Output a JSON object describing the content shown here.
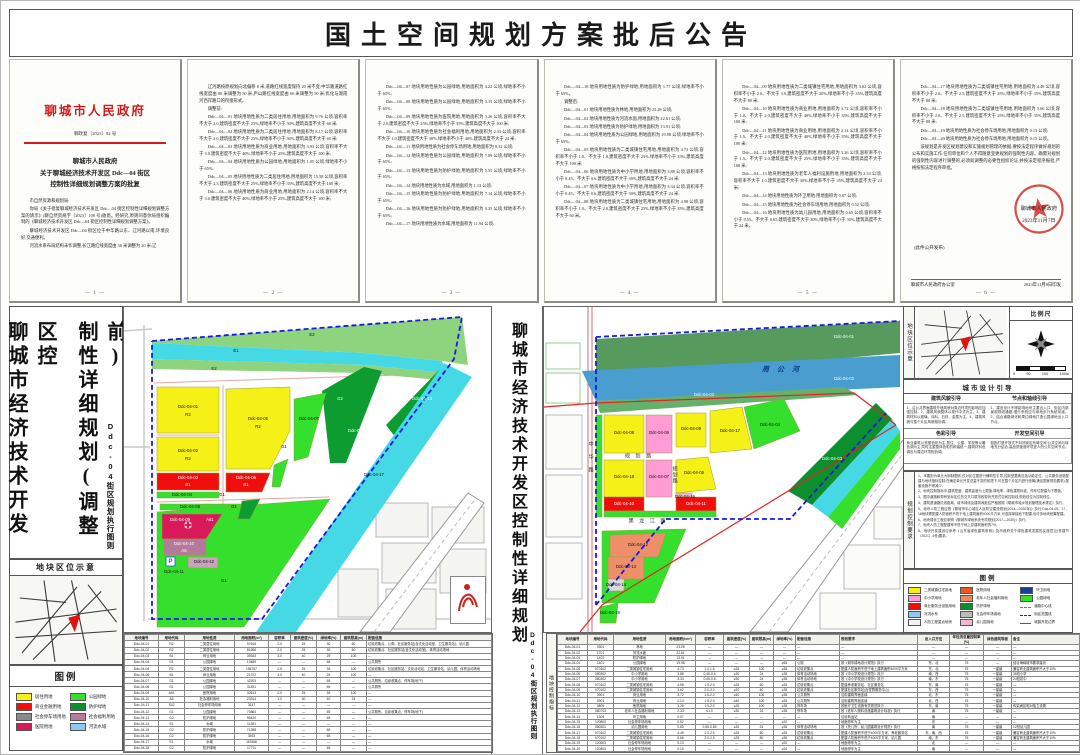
{
  "banner": {
    "title": "国土空间规划方案批后公告"
  },
  "doc": {
    "agency": "聊城市人民政府",
    "doc_no": "聊政复〔2023〕82 号",
    "title_l1": "聊城市人民政府",
    "title_l2": "关于聊城经济技术开发区 Ddc—04 街区",
    "title_l3": "控制性详细规划调整方案的批复",
    "p1": [
      "市自然资源和规划局:",
      "你局《关于批复聊城经济技术开发区 Ddc—04 街区控制性详细规划调整方案的请示》(聊自然资规字〔2023〕108 号)收悉。经研究,原则同意你局组织编制的《聊城经济技术开发区 Ddc—04 街区控制性详细规划调整方案》。",
      "聊城经济技术开发区 Ddc—04 街区位于中华路以东、辽河路以南,环境良好,交通便利。",
      "河流水系布局结构未作调整,长江路红线宽度由 36 米调整为 20 米;辽"
    ],
    "p2": [
      "辽河路按原规划向北偏移 8 米,道路红线宽度保持 20 米不变;中华路道路红线宽度由 80 米调整为 50 米;庐山路红线宽度由 60 米调整为 50 米;优化与湖南河西岸路口的衔接形式。",
      "调整前:",
      "Ddc—04—01 地块用地性质为二类居住用地,用地面积为 9.76 公顷,容积率不大于 2.0,建筑密度不大于 25%,绿地率不小于 30%,建筑高度不大于 60 米;",
      "Ddc—04—02 地块用地性质为二类居住用地,用地面积为 8.17 公顷,容积率不大于 2.0,建筑密度不大于 25%,绿地率不小于 30%,建筑高度不大于 60 米;",
      "Ddc—04—03 地块用地性质为商业用地,用地面积为 3.93 公顷,容积率不大于 3.0,建筑密度不大于 40%,绿地率不小于 25%,建筑高度不大于 100 米;",
      "Ddc—04—04 地块用地性质为公园绿地,用地面积为 1.05 公顷,绿地率不小于 65%;",
      "Ddc—04—05 地块用地性质为二类居住用地,用地面积为 15.58 公顷,容积率不大于 2.5,建筑密度不大于 25%,绿地率不小于 35%,建筑高度不大于 100 米;",
      "Ddc—04—06 地块用地性质为商业用地,用地面积为 2.14 公顷,容积率不大于 3.0,建筑密度不大于 40%,绿地率不小于 25%,建筑高度不大于 100 米;"
    ],
    "p3": [
      "Ddc—04—07 地块用地性质为公园绿地,用地面积为 4.22 公顷,绿地率不小于 65%;",
      "Ddc—04—08 地块用地性质为公园绿地,用地面积为 3.15 公顷,绿地率不小于 65%;",
      "Ddc—04—09 地块用地性质为医院用地,用地面积为 3.26 公顷,容积率不大于 2.0,建筑密度不大于 25%,绿地率不小于 35%,建筑高度不大于 100 米;",
      "Ddc—04—10 地块用地性质为社会福利用地,用地面积为 2.33 公顷,容积率不大于 1.0,建筑密度不大于 30%,绿地率不小于 40%,建筑高度不大于 24 米;",
      "Ddc—04—11 地块用地性质为社会停车场用地,用地面积为 0.32 公顷;",
      "Ddc—04—12 地块用地性质为公园绿地,用地面积为 7.09 公顷,绿地率不小于 65%;",
      "Ddc—04—13 地块用地性质为防护绿地,用地面积为 5.55 公顷,绿地率不小于 65%;",
      "Ddc—04—14 地块用地性质为水域,用地面积为 1.13 公顷;",
      "Ddc—04—15 地块用地性质为防护绿地,用地面积为 7.14 公顷,绿地率不小于 65%;",
      "Ddc—04—16 地块用地性质为防护绿地,用地面积为 0.35 公顷,绿地率不小于 65%;",
      "Ddc—04—17 地块用地性质为水域,用地面积为 11.94 公顷;"
    ],
    "p4": [
      "Ddc—04—18 地块用地性质为防护绿地,用地面积为 1.77 公顷,绿地率不小于 65%。",
      "调整后:",
      "Ddc—04—01 地块用地性质为林地,用地面积为 23.28 公顷;",
      "Ddc—04—02 地块用地性质为河流水面,用地面积为 22.61 公顷;",
      "Ddc—04—03 地块用地性质为防护绿地,用地面积为 13.91 公顷;",
      "Ddc—04—04 地块用地性质为公园绿地,用地面积为 19.98 公顷,绿地率不小于 65%;",
      "Ddc—04—05 地块用地性质为二类城镇住宅用地,用地面积为 4.73 公顷,容积率不小于 1.0、不大于 1.8,建筑密度不大于 25%,绿地率不小于 35%,建筑高度不大于 100 米;",
      "Ddc—04—06 地块用地性质为中小学用地,用地面积为 3.88 公顷,容积率不小于 0.45、不大于 0.6,建筑密度不大于 30%,建筑高度不大于 24 米;",
      "Ddc—04—07 地块用地性质为中小学用地,用地面积为 3.34 公顷,容积率不小于 0.45、不大于 0.6,建筑密度不大于 30%,建筑高度不大于 24 米;",
      "Ddc—04—08 地块用地性质为二类城镇住宅用地,用地面积为 4.98 公顷,容积率不小于 1.0、不大于 2.0,建筑密度不大于 25%,绿地率不小于 35%,建筑高度不大于 60 米。"
    ],
    "p5": [
      "Ddc—04—09 地块用地性质为二类城镇住宅用地,用地面积为 3.62 公顷,容积率不小于 2.0、不大于 3.0,建筑密度不大于 20%,绿地率不小于 35%,建筑高度不大于 80 米;",
      "Ddc—04—10 地块用地性质为商业用地,用地面积为 3.72 公顷,容积率不小于 1.0、不大于 2.0,建筑密度不大于 40%,绿地率不小于 35%,建筑高度不大于 100 米;",
      "Ddc—04—11 地块用地性质为商业用地,用地面积为 2.14 公顷,容积率不小于 1.5、不大于 2.0,建筑密度不大于 40%,绿地率不小于 35%,建筑高度不大于 100 米;",
      "Ddc—04—12 地块用地性质为医院用地,用地面积为 3.26 公顷,容积率不小于 1.5、不大于 2.0,建筑密度不大于 25%,绿地率不小于 35%,建筑高度不大于 100 米;",
      "Ddc—04—13 地块用地性质为老年人福利设施用地,用地面积为 2.33 公顷,容积率不大于 1.0,建筑密度不大于 30%,绿地率不小于 35%,建筑高度不大于 24 米;",
      "Ddc—04—14 地块用地性质为环卫用地,用地面积为 0.07 公顷;",
      "Ddc—04—15 地块用地性质为社会停车场用地,用地面积为 0.52 公顷;",
      "Ddc—04—16 地块用地性质为幼儿园用地,用地面积为 0.65 公顷,容积率不小于 0.55、不大于 0.65,建筑密度不大于 30%,绿地率不小于 35%,建筑高度不大于 24 米。"
    ],
    "p6": [
      "Ddc—04—17 地块用地性质为二类城镇住宅用地,用地面积为 4.49 公顷,容积率不小于 2.0、不大于 2.5,建筑密度不大于 25%,绿地率不小于 35%,建筑高度不大于 80 米;",
      "Ddc—04—18 地块用地性质为二类城镇住宅用地,用地面积为 5.66 公顷,容积率不小于 2.0、不大于 2.5,建筑密度不大于 25%,绿地率不小于 35%,建筑高度不大于 80 米;",
      "Ddc—04—19 地块用地性质为社会停车场用地,用地面积为 0.13 公顷;",
      "Ddc—04—20 地块用地性质为社会停车场用地,用地面积为 0.15 公顷。",
      "该规划是开发区规划建设和实施规划管理的依据,要按法定程序做好规划的公布和实施工作,任何单位和个人不得随意变更规划的强制性内容。确需对规划的强制性内容进行调整的,必须就调整的必要性组织论证,并按法定程序报批,严格按照法定程序审批。"
    ],
    "page_nums": [
      "— 1 —",
      "— 2 —",
      "— 3 —",
      "— 4 —",
      "— 5 —",
      "— 6 —"
    ],
    "seal_name": "聊城市人民政府",
    "seal_date": "2023年11月7日",
    "pub_note": "(此件公开发布)",
    "footer_left": "聊城市人民政府办公室",
    "footer_right": "2023年11月8日印发"
  },
  "left_panel": {
    "title_col1": "聊城市经济技术开发区控",
    "title_col2": "制性详细规划(调整前)",
    "subtitle": "Ddc-04街区规划执行图则",
    "locator_title": "地块区位示意",
    "legend_title": "图例",
    "legend": [
      {
        "c": "#f5f116",
        "t": "居住用地"
      },
      {
        "c": "#35e02c",
        "t": "公园绿地"
      },
      {
        "c": "#f20d0d",
        "t": "商业金融用地"
      },
      {
        "c": "#0c8f2e",
        "t": "防护绿地"
      },
      {
        "c": "#8a8a8a",
        "t": "社会停车场用地"
      },
      {
        "c": "#b5799c",
        "t": "社会福利用地"
      },
      {
        "c": "#d8195a",
        "t": "医院用地"
      },
      {
        "c": "#8fc8f2",
        "t": "河流水域"
      }
    ]
  },
  "center_strip": {
    "title": "聊城市经济技术开发区控制性详细规划",
    "subtitle": "Ddc-04街区规划执行图则"
  },
  "right_panel": {
    "locator_label": "地块区位示意",
    "scale_title": "比例尺",
    "scale_labels": [
      "0",
      "50",
      "100",
      "150m"
    ],
    "design_title": "城市设计引导",
    "design_sections": [
      {
        "h": "建筑风貌引导",
        "b": "1、沿公共界面建筑外墙风貌对周边环境的影响应加强控制。2、建筑风貌整体以现代中式为主。3、建筑材料以玻璃、涂料、石材、金属为主。4、建筑风貌与整个片区风貌相协调。"
      },
      {
        "h": "节点和轴线引导",
        "b": "1、建设设计不得影响地块主要出入口、街区内部景观视线通廊,慢行系统应与绿地步行系统衔接。2、结合道路绿化和周边绿地打造公园绿地出入口节点。"
      },
      {
        "h": "色彩引导",
        "b": "商业建筑以亮丽色彩为主,居住、公建、学校等以暖色调为主,同时注重整体色彩的和谐统一,建筑材料色调应与周边环境相协调。"
      },
      {
        "h": "开发空间引导",
        "b": "鼓励打造开放式不封闭街区布局空间,公共空间与绿地充分结合,高品质营造环境宜人的公共空间节点。"
      }
    ],
    "controls_label": "规划控制要求",
    "controls": [
      "1、本图则为单元大纲制图则,仅对区位图进行辅助性引导,控制型要素包括功能定位、公共服务设施配建与地块指标控制;在确定单元开发总量不变的前提下,可在整个片区内进行统筹(满足国家规范要求),配套设施不得减少。",
      "2、地块控制指标中,建筑密度、建筑高度为上限值,绿地率、绿色建筑标准、停车位配建为下限值。",
      "3、图中道路和带有坐标定位的交叉口属市政带状开放式空间控制线,规划线位为控制线位。",
      "4、建筑退道路红线距离、城市绿线及建筑间距应严格按照《聊城市城乡规划管理技术规定》执行。",
      "5、地块人防工程应按《聊城市中心城区人民防空建设规划(2014—2030年)》执行;Ddc-04-05、17、18地块需配建人防面积不低于地上建筑面积4000平方米,可选择单独地下配建,也可多地块统筹配建。",
      "6、地块绿化工程应参照《聊城市绿地系统专项规划(2017—2030)》执行。",
      "7、地块人防工程配建率不低于地上总建筑面积的7%。",
      "8、地块开发建设应参考《山东省绿色建筑条例》及市政府关于绿色建筑发展的实施意见(鲁建节〔2021〕4号)要求。"
    ],
    "legend_title": "图例",
    "legend": [
      {
        "c": "#f5f116",
        "t": "二类城镇住宅用地",
        "k": "swatch"
      },
      {
        "c": "#e85a2a",
        "t": "医院用地",
        "k": "swatch"
      },
      {
        "c": "#163f8f",
        "t": "环卫用地",
        "k": "swatch"
      },
      {
        "c": "#ff9bd5",
        "t": "中小学用地",
        "k": "swatch"
      },
      {
        "c": "#f0885f",
        "t": "老年人社会福利用地",
        "k": "swatch"
      },
      {
        "c": "#35e02c",
        "t": "公园绿地",
        "k": "swatch"
      },
      {
        "c": "#f20d0d",
        "t": "商业服务业设施用地",
        "k": "swatch"
      },
      {
        "c": "#0c8f2e",
        "t": "防护绿地",
        "k": "swatch"
      },
      {
        "c": "",
        "t": "道路中心线",
        "k": "dash-gray"
      },
      {
        "c": "#8fc8f2",
        "t": "河流水系",
        "k": "swatch"
      },
      {
        "c": "#bcbcbc",
        "t": "社会停车场用地",
        "k": "swatch"
      },
      {
        "c": "",
        "t": "街区范围线",
        "k": "dash-blue"
      },
      {
        "c": "#f2f2f2",
        "t": "人防工程重点地块",
        "k": "swatch"
      },
      {
        "c": "#f7b7d2",
        "t": "幼儿园用地",
        "k": "swatch"
      },
      {
        "c": "",
        "t": "城镇开发边界",
        "k": "line-red"
      }
    ]
  },
  "left_map_labels": [
    {
      "x": 188,
      "y": 28,
      "t": "E2"
    },
    {
      "x": 112,
      "y": 44,
      "t": "E1"
    },
    {
      "x": 90,
      "y": 62,
      "t": "E2"
    },
    {
      "x": 64,
      "y": 100,
      "t": "Ddc-04-01"
    },
    {
      "x": 64,
      "y": 108,
      "t": "R2"
    },
    {
      "x": 134,
      "y": 112,
      "t": "Ddc-04-05"
    },
    {
      "x": 134,
      "y": 120,
      "t": "R2"
    },
    {
      "x": 185,
      "y": 112,
      "t": "Ddc-04-07"
    },
    {
      "x": 216,
      "y": 92,
      "t": "G2",
      "c": "smw"
    },
    {
      "x": 234,
      "y": 124,
      "t": "Ddc-04-15",
      "c": "smw"
    },
    {
      "x": 298,
      "y": 92,
      "t": "Ddc-04-13",
      "c": "smw"
    },
    {
      "x": 250,
      "y": 168,
      "t": "Ddc-04-17"
    },
    {
      "x": 64,
      "y": 144,
      "t": "Ddc-04-02"
    },
    {
      "x": 64,
      "y": 152,
      "t": "R2"
    },
    {
      "x": 64,
      "y": 171,
      "t": "Ddc-04-03",
      "c": "smw"
    },
    {
      "x": 64,
      "y": 178,
      "t": "B1",
      "c": "smw"
    },
    {
      "x": 122,
      "y": 171,
      "t": "Ddc-04-06",
      "c": "smw"
    },
    {
      "x": 122,
      "y": 178,
      "t": "B1",
      "c": "smw"
    },
    {
      "x": 58,
      "y": 188,
      "t": "Ddc-04-04"
    },
    {
      "x": 98,
      "y": 188,
      "t": "G1"
    },
    {
      "x": 66,
      "y": 200,
      "t": "Ddc-04-08"
    },
    {
      "x": 110,
      "y": 200,
      "t": "G1"
    },
    {
      "x": 56,
      "y": 213,
      "t": "Ddc-04-09",
      "c": "smw"
    },
    {
      "x": 86,
      "y": 213,
      "t": "A51",
      "c": "smw"
    },
    {
      "x": 60,
      "y": 237,
      "t": "Ddc-04-10",
      "c": "smw"
    },
    {
      "x": 60,
      "y": 244,
      "t": "A6",
      "c": "smw"
    },
    {
      "x": 80,
      "y": 255,
      "t": "Ddc-04-12"
    },
    {
      "x": 50,
      "y": 265,
      "t": "Ddc-04-11"
    },
    {
      "x": 46.5,
      "y": 254.5,
      "t": "P",
      "c": "pp"
    },
    {
      "x": 100,
      "y": 274,
      "t": "G1"
    },
    {
      "x": 160,
      "y": 140,
      "t": "G1"
    }
  ],
  "right_map_labels": [
    {
      "x": 300,
      "y": 30,
      "t": "Ddc-04-01",
      "c": "smw"
    },
    {
      "x": 238,
      "y": 63,
      "t": "周 公 河",
      "c": "river"
    },
    {
      "x": 300,
      "y": 72,
      "t": "Ddc-04-02",
      "c": "smw"
    },
    {
      "x": 160,
      "y": 88,
      "t": "Ddc-04-03",
      "c": "smw"
    },
    {
      "x": 226,
      "y": 118,
      "t": "Ddc-04-04"
    },
    {
      "x": 80,
      "y": 126,
      "t": "Ddc-04-08"
    },
    {
      "x": 115,
      "y": 126,
      "t": "Ddc-04-06"
    },
    {
      "x": 147,
      "y": 122,
      "t": "Ddc-04-09"
    },
    {
      "x": 186,
      "y": 124,
      "t": "Ddc-04-17"
    },
    {
      "x": 95,
      "y": 150,
      "t": "规 划 路",
      "c": "road"
    },
    {
      "x": 80,
      "y": 170,
      "t": "Ddc-04-18"
    },
    {
      "x": 115,
      "y": 170,
      "t": "Ddc-04-07"
    },
    {
      "x": 150,
      "y": 166,
      "t": "Ddc-04-05"
    },
    {
      "x": 141,
      "y": 190,
      "t": "Ddc-04-16"
    },
    {
      "x": 80,
      "y": 197,
      "t": "Ddc-04-10",
      "c": "smw"
    },
    {
      "x": 152,
      "y": 197,
      "t": "Ddc-04-11",
      "c": "smw"
    },
    {
      "x": 104,
      "y": 215,
      "t": "黑 龙 江 路",
      "c": "road"
    },
    {
      "x": 94,
      "y": 238,
      "t": "Ddc-04-12"
    },
    {
      "x": 82,
      "y": 260,
      "t": "Ddc-04-13"
    },
    {
      "x": 72,
      "y": 278,
      "t": "Ddc-04-14"
    },
    {
      "x": 66,
      "y": 306,
      "t": "Ddc-04-19"
    },
    {
      "x": 46,
      "y": 150,
      "t": "中 华 路",
      "c": "roadv"
    },
    {
      "x": 130,
      "y": 168,
      "t": "规划路",
      "c": "roadv"
    },
    {
      "x": 288,
      "y": 152,
      "t": "Ddc-04-03",
      "c": "smw"
    }
  ],
  "left_table": {
    "rows": [
      [
        "地块编号",
        "用地代码",
        "用地性质",
        "用地面积(m²)",
        "容积率",
        "建筑密度(%)",
        "绿地率(%)",
        "建筑限高(m)",
        "配套设施"
      ],
      [
        "Ddc-04-01",
        "R2",
        "二类居住用地",
        "97616",
        "2.0",
        "25",
        "30",
        "60",
        "垃圾收集点、公厕、社区服务站(含文化活动室、卫生服务站)、幼儿园"
      ],
      [
        "Ddc-04-02",
        "R2",
        "二类居住用地",
        "81696",
        "2.0",
        "25",
        "30",
        "60",
        "垃圾收集点、社区服务站(含文化活动室)、体育活动场地"
      ],
      [
        "Ddc-04-03",
        "B1",
        "商业用地",
        "39343",
        "3.0",
        "40",
        "25",
        "100",
        "—"
      ],
      [
        "Ddc-04-04",
        "G1",
        "公园绿地",
        "10489",
        "—",
        "—",
        "65",
        "—",
        "公共厕所"
      ],
      [
        "Ddc-04-05",
        "R2",
        "二类居住用地",
        "155757",
        "2.5",
        "25",
        "35",
        "100",
        "垃圾收集点、社区服务站、文化活动站、卫生服务站、幼儿园、体育活动场地"
      ],
      [
        "Ddc-04-06",
        "B1",
        "商业用地",
        "21372",
        "3.0",
        "40",
        "25",
        "100",
        "—"
      ],
      [
        "Ddc-04-07",
        "G1",
        "公园绿地",
        "42203",
        "—",
        "—",
        "65",
        "—",
        "公共厕所、垃圾收集点、停车场(地下)"
      ],
      [
        "Ddc-04-08",
        "G1",
        "公园绿地",
        "31491",
        "—",
        "—",
        "65",
        "—",
        "公共厕所"
      ],
      [
        "Ddc-04-09",
        "A51",
        "医院用地",
        "32613",
        "2.0",
        "25",
        "35",
        "100",
        "—"
      ],
      [
        "Ddc-04-10",
        "A6",
        "社会福利用地",
        "23314",
        "1.0",
        "30",
        "40",
        "24",
        "—"
      ],
      [
        "Ddc-04-11",
        "S42",
        "社会停车场用地",
        "3147",
        "—",
        "—",
        "—",
        "—",
        "—"
      ],
      [
        "Ddc-04-12",
        "G1",
        "公园绿地",
        "70864",
        "—",
        "—",
        "65",
        "—",
        "公共厕所、垃圾收集点、停车场(地下)"
      ],
      [
        "Ddc-04-13",
        "G2",
        "防护绿地",
        "55420",
        "—",
        "—",
        "65",
        "—",
        "—"
      ],
      [
        "Ddc-04-14",
        "E1",
        "水域",
        "11281",
        "—",
        "—",
        "—",
        "—",
        "—"
      ],
      [
        "Ddc-04-15",
        "G2",
        "防护绿地",
        "71398",
        "—",
        "—",
        "65",
        "—",
        "—"
      ],
      [
        "Ddc-04-16",
        "G2",
        "防护绿地",
        "3493",
        "—",
        "—",
        "65",
        "—",
        "—"
      ],
      [
        "Ddc-04-17",
        "E1",
        "水域",
        "119366",
        "—",
        "—",
        "—",
        "—",
        "—"
      ],
      [
        "Ddc-04-18",
        "G2",
        "防护绿地",
        "17711",
        "—",
        "—",
        "65",
        "—",
        "—"
      ]
    ]
  },
  "right_table": {
    "side_label": "地块控制指标",
    "rows": [
      [
        "地块编号",
        "用地代码",
        "用地性质",
        "用地面积(hm²)",
        "容积率",
        "建筑密度(%)",
        "建筑限高(m)",
        "绿地率(%)",
        "配套设施",
        "规划要求",
        "出入口方位",
        "年径流总量控制率(%)",
        "绿色建筑等级",
        "备注"
      ],
      [
        "Ddc-04-01",
        "0301",
        "林地",
        "23.28",
        "—",
        "—",
        "—",
        "—",
        "—",
        "—",
        "—",
        "—",
        "—",
        "—"
      ],
      [
        "Ddc-04-02",
        "1701",
        "河流水面",
        "22.61",
        "—",
        "—",
        "—",
        "—",
        "—",
        "—",
        "—",
        "—",
        "—",
        "—"
      ],
      [
        "Ddc-04-03",
        "1402",
        "防护绿地",
        "13.91",
        "—",
        "—",
        "—",
        "—",
        "—",
        "—",
        "—",
        "—",
        "—",
        "—"
      ],
      [
        "Ddc-04-04",
        "1401",
        "公园绿地",
        "19.98",
        "—",
        "—",
        "—",
        "≥65",
        "公厕",
        "按《城市绿地设计规范》执行",
        "东、北",
        "75",
        "—",
        "结合海绵城市要求建设"
      ],
      [
        "Ddc-04-05",
        "070102",
        "二类城镇住宅用地",
        "4.73",
        "1.0-1.8",
        "≤25",
        "100",
        "≥35",
        "垃圾收集点",
        "配建人防面积不低于地上建筑面积4000平方米",
        "东、北",
        "75",
        "一星级",
        "兼容商业建筑面积不大于10%"
      ],
      [
        "Ddc-04-06",
        "080302",
        "中小学用地",
        "3.88",
        "0.45-0.6",
        "≤30",
        "24",
        "≥35",
        "体育活动场地",
        "按《中小学校设计规范》执行",
        "南、西",
        "75",
        "一星级",
        "36班小学"
      ],
      [
        "Ddc-04-07",
        "080302",
        "中小学用地",
        "3.34",
        "0.45-0.6",
        "≤30",
        "24",
        "≥35",
        "体育活动场地",
        "按《中小学校设计规范》执行",
        "南、东",
        "75",
        "一星级",
        "24班初中"
      ],
      [
        "Ddc-04-08",
        "070102",
        "二类城镇住宅用地",
        "4.98",
        "1.0-2.0",
        "≤25",
        "60",
        "≥35",
        "垃圾收集点",
        "配建养老服务站、社区服务站",
        "东、南",
        "75",
        "一星级",
        "—"
      ],
      [
        "Ddc-04-09",
        "070102",
        "二类城镇住宅用地",
        "3.62",
        "2.0-3.0",
        "≤20",
        "80",
        "≥35",
        "垃圾收集点",
        "配建社区服务站(含党群服务中心)",
        "东、西",
        "75",
        "一星级",
        "—"
      ],
      [
        "Ddc-04-10",
        "0901",
        "商业用地",
        "3.72",
        "1.5-2.0",
        "≤40",
        "100",
        "≥35",
        "公共厕所",
        "沿街建筑界面连续",
        "北、东",
        "75",
        "一星级",
        "—"
      ],
      [
        "Ddc-04-11",
        "0901",
        "商业用地",
        "2.14",
        "1.5-2.0",
        "≤40",
        "100",
        "≥35",
        "公共厕所",
        "沿街建筑界面连续",
        "北、西",
        "75",
        "一星级",
        "—"
      ],
      [
        "Ddc-04-12",
        "0809",
        "医院用地",
        "3.26",
        "1.5-2.0",
        "≤25",
        "100",
        "≥35",
        "停车场",
        "按医疗卫生设施有关规范执行",
        "东、南",
        "75",
        "一星级",
        "传染病区相对独立设置"
      ],
      [
        "Ddc-04-13",
        "080703",
        "老年人社会福利用地",
        "2.33",
        "≤1.0",
        "≤30",
        "24",
        "≥35",
        "停车场",
        "按《老年人照料设施建筑设计标准》执行",
        "南",
        "75",
        "一星级",
        "—"
      ],
      [
        "Ddc-04-14",
        "1309",
        "环卫用地",
        "0.07",
        "—",
        "—",
        "—",
        "—",
        "—",
        "垃圾转运站",
        "南",
        "—",
        "—",
        "—"
      ],
      [
        "Ddc-04-15",
        "120803",
        "社会停车场用地",
        "0.52",
        "—",
        "—",
        "—",
        "≥20",
        "—",
        "地面停车为主",
        "东",
        "—",
        "—",
        "—"
      ],
      [
        "Ddc-04-16",
        "080301",
        "幼儿园用地",
        "0.65",
        "0.55-0.65",
        "≤30",
        "24",
        "≥35",
        "体育活动场地",
        "按《托儿所、幼儿园建筑设计规范》执行",
        "南",
        "75",
        "一星级",
        "12班幼儿园"
      ],
      [
        "Ddc-04-17",
        "070102",
        "二类城镇住宅用地",
        "4.49",
        "2.0-2.5",
        "≤25",
        "80",
        "≥35",
        "垃圾收集点",
        "配建人防面积不低于4000平方米、养老服务站",
        "东、南、西",
        "75",
        "一星级",
        "兼容商业建筑面积不大于10%"
      ],
      [
        "Ddc-04-18",
        "070102",
        "二类城镇住宅用地",
        "5.66",
        "2.0-2.5",
        "≤25",
        "80",
        "≥35",
        "垃圾收集点",
        "配建人防面积不低于4000平方米、幼儿园",
        "南、东",
        "75",
        "一星级",
        "兼容商业建筑面积不大于10%"
      ],
      [
        "Ddc-04-19",
        "120803",
        "社会停车场用地",
        "0.13",
        "—",
        "—",
        "—",
        "≥20",
        "—",
        "地面停车为主",
        "北",
        "—",
        "—",
        "—"
      ],
      [
        "Ddc-04-20",
        "120803",
        "社会停车场用地",
        "0.15",
        "—",
        "—",
        "—",
        "≥20",
        "—",
        "地面停车为主",
        "南",
        "—",
        "—",
        "—"
      ]
    ]
  }
}
